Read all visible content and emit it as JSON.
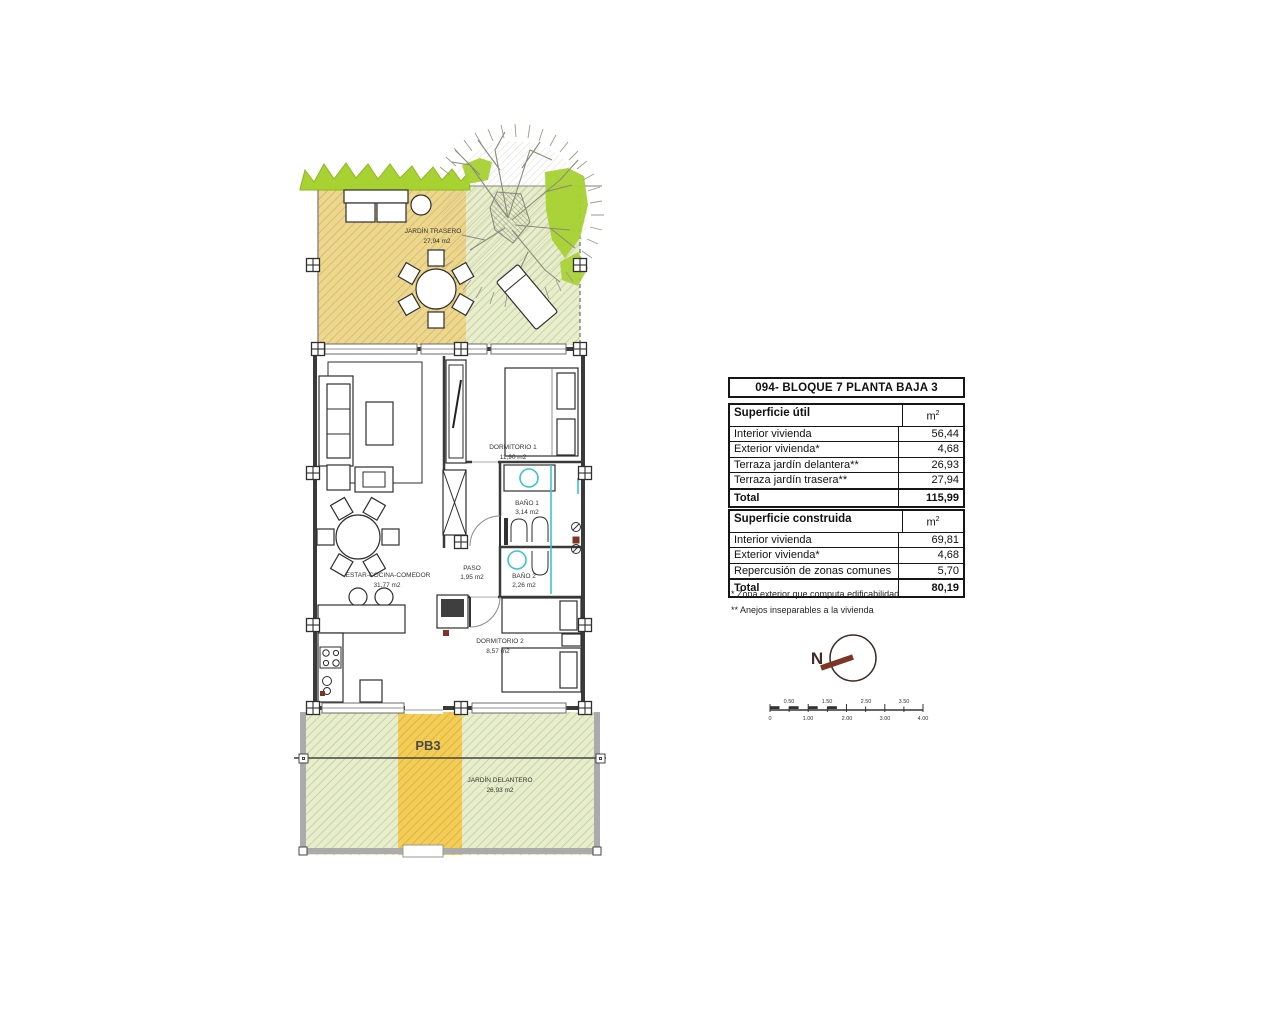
{
  "header": {
    "title": "094- BLOQUE 7 PLANTA BAJA 3"
  },
  "surface_util": {
    "title": "Superficie útil",
    "unit_base": "m",
    "unit_exp": "2",
    "rows": [
      {
        "label": "Interior vivienda",
        "value": "56,44"
      },
      {
        "label": "Exterior vivienda*",
        "value": "4,68"
      },
      {
        "label": "Terraza jardín delantera**",
        "value": "26,93"
      },
      {
        "label": "Terraza jardín trasera**",
        "value": "27,94"
      }
    ],
    "total_label": "Total",
    "total_value": "115,99"
  },
  "surface_construida": {
    "title": "Superficie construida",
    "unit_base": "m",
    "unit_exp": "2",
    "rows": [
      {
        "label": "Interior vivienda",
        "value": "69,81"
      },
      {
        "label": "Exterior vivienda*",
        "value": "4,68"
      },
      {
        "label": "Repercusión de zonas comunes",
        "value": "5,70"
      }
    ],
    "total_label": "Total",
    "total_value": "80,19"
  },
  "footnotes": {
    "one": "* Zona exterior que computa edificabilidad",
    "two": "** Anejos inseparables a la vivienda"
  },
  "plan": {
    "jardin_trasero_name": "JARDÍN TRASERO",
    "jardin_trasero_area": "27,94 m2",
    "estar_name": "ESTAR-COCINA-COMEDOR",
    "estar_area": "31,77 m2",
    "dormitorio1_name": "DORMITORIO 1",
    "dormitorio1_area": "11,90 m2",
    "bano1_name": "BAÑO 1",
    "bano1_area": "3,14 m2",
    "paso_name": "PASO",
    "paso_area": "1,95 m2",
    "bano2_name": "BAÑO 2",
    "bano2_area": "2,26 m2",
    "dormitorio2_name": "DORMITORIO 2",
    "dormitorio2_area": "8,57 m2",
    "jardin_delantero_name": "JARDÍN DELANTERO",
    "jardin_delantero_area": "26,93 m2",
    "unit_tag": "PB3"
  },
  "compass": {
    "north": "N"
  },
  "scale": {
    "top": [
      "0.50",
      "1.50",
      "2.50",
      "3.50"
    ],
    "bottom": [
      "0",
      "1.00",
      "2.00",
      "3.00",
      "4.00"
    ]
  },
  "colors": {
    "hatch_tan": "#ecd78f",
    "hatch_green": "#e8edcd",
    "band_yellow": "#f2ce58",
    "foliage": "#a7d232",
    "teal": "#3cc3cb",
    "needle": "#7d3526"
  }
}
